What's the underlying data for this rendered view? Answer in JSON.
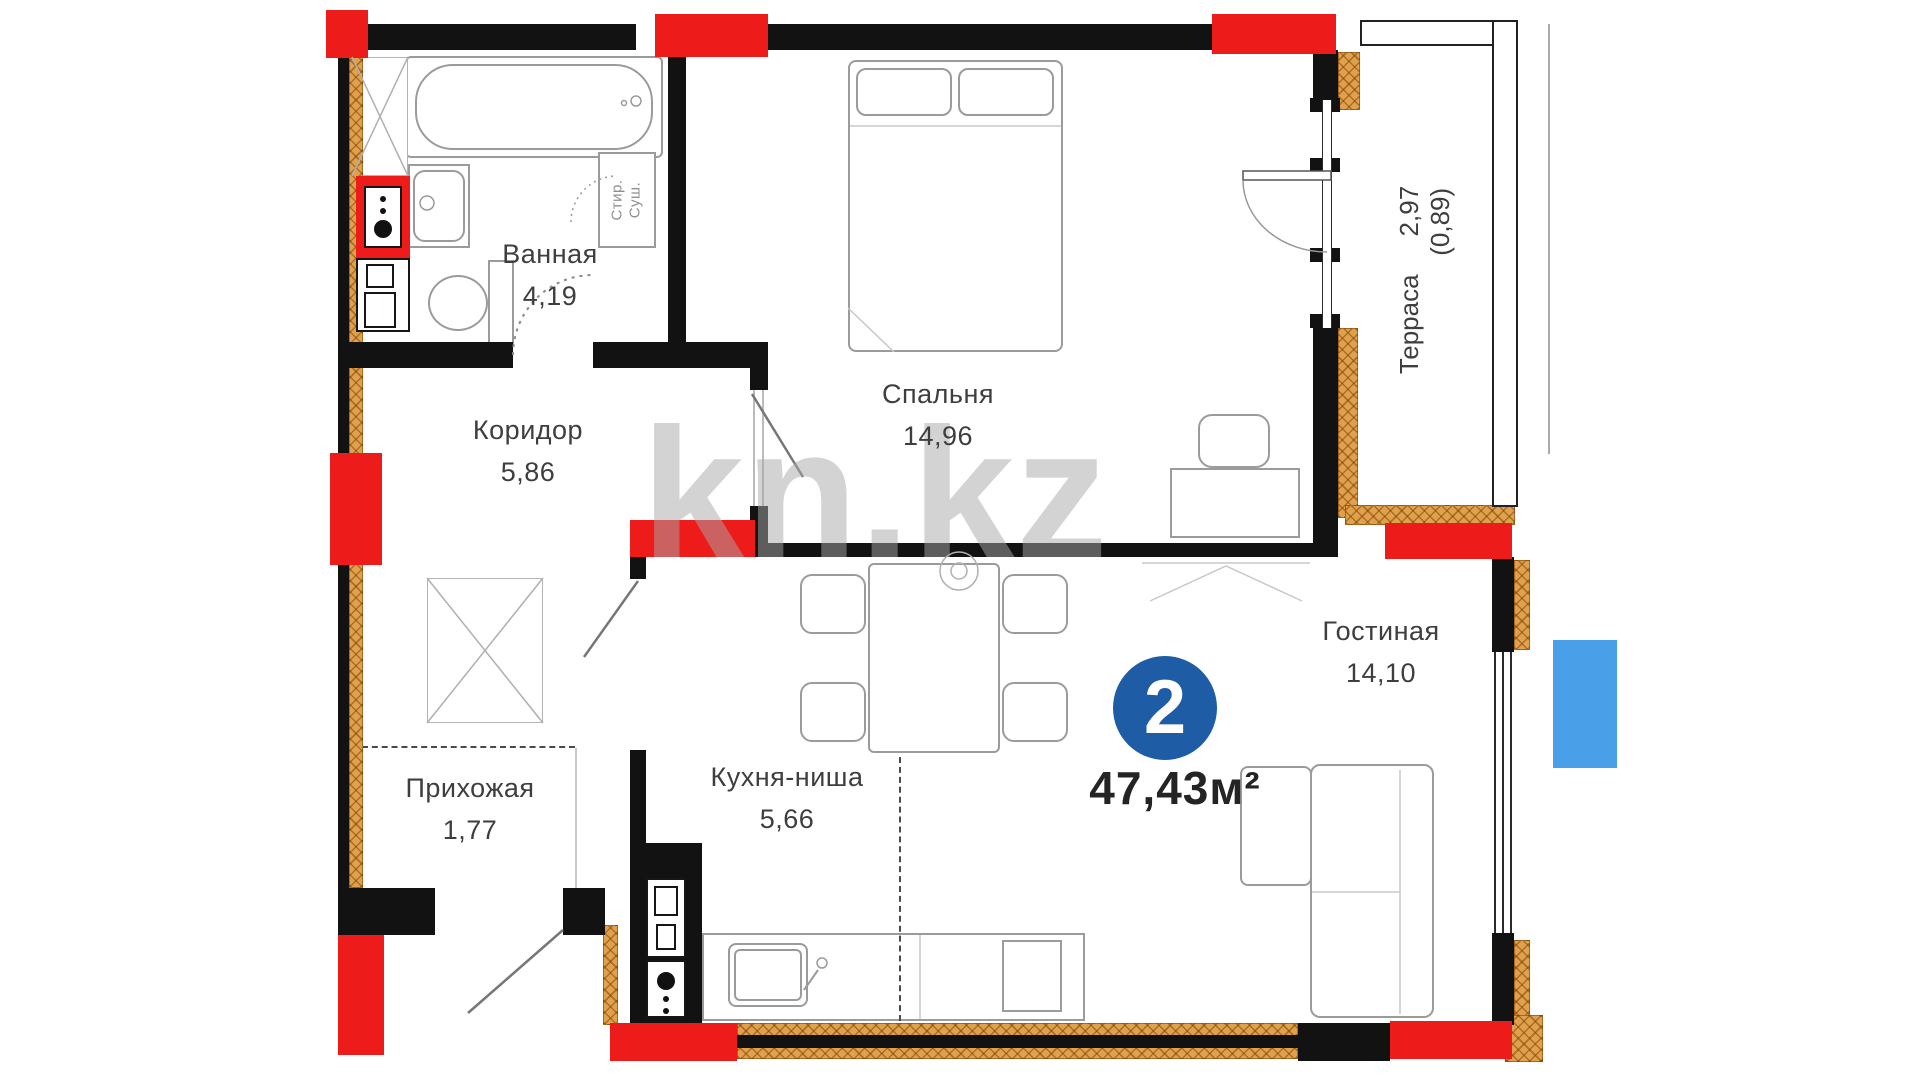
{
  "plan": {
    "badge": {
      "rooms": "2",
      "area": "47,43м²"
    },
    "watermark": "kn.kz",
    "rooms": [
      {
        "name": "Ванная",
        "area": "4,19"
      },
      {
        "name": "Коридор",
        "area": "5,86"
      },
      {
        "name": "Спальня",
        "area": "14,96"
      },
      {
        "name": "Прихожая",
        "area": "1,77"
      },
      {
        "name": "Кухня-ниша",
        "area": "5,66"
      },
      {
        "name": "Гостиная",
        "area": "14,10"
      },
      {
        "name": "Терраса",
        "area": "2,97",
        "area_reduced": "(0,89)"
      }
    ],
    "appliances": {
      "washer": "Стир.",
      "dryer": "Суш."
    },
    "colors": {
      "wall": "#121212",
      "column_red": "#ee1b1b",
      "insulation_orange": "#e0a14d",
      "badge_blue": "#1e5ca6",
      "highlight_blue": "#4aa0e8",
      "label": "#3e3e3e",
      "fixture_line": "#9b9b9b",
      "watermark": "rgba(168,168,168,0.5)"
    }
  }
}
